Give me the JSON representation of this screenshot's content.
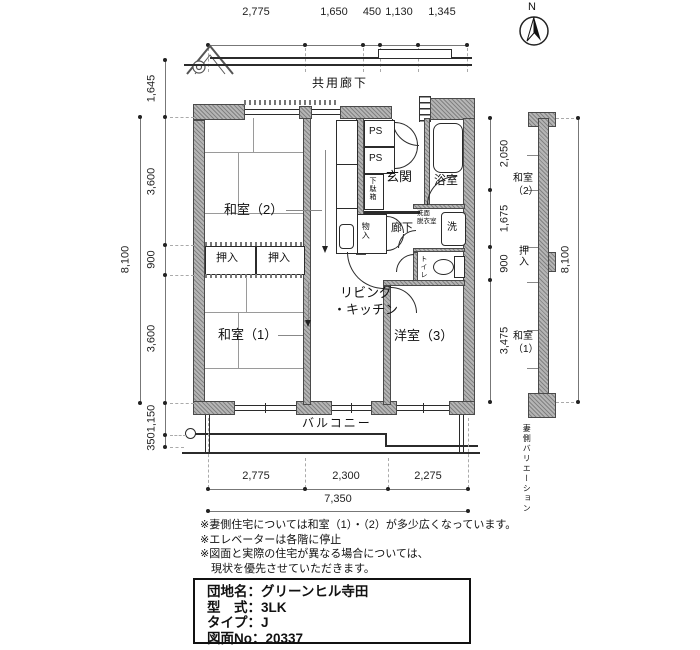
{
  "compass": {
    "n": "N"
  },
  "corridor": {
    "label": "共用廊下"
  },
  "dims": {
    "top": [
      "2,775",
      "1,650",
      "450",
      "1,130",
      "1,345"
    ],
    "left": [
      "1,645",
      "3,600",
      "900",
      "3,600",
      "1,150",
      "350"
    ],
    "left_overall": "8,100",
    "bottom": [
      "2,775",
      "2,300",
      "2,275"
    ],
    "bottom_overall": "7,350",
    "right": [
      "2,050",
      "1,675",
      "900",
      "3,475"
    ],
    "right_overall": "8,100"
  },
  "rooms": {
    "washitsu2": "和室（2）",
    "washitsu1": "和室（1）",
    "living_l1": "リビング",
    "living_l2": "・キッチン",
    "youshitsu3": "洋室（3）",
    "genkan": "玄関",
    "bath": "浴室",
    "ps1": "PS",
    "ps2": "PS",
    "getabako": "下駄箱",
    "oshiire1": "押入",
    "oshiire2": "押入",
    "monoire": "物入",
    "rouka": "廊下",
    "toire": "トイレ",
    "senmen_l1": "洗面",
    "senmen_l2": "脱衣室",
    "sen": "洗",
    "balcony": "バルコニー"
  },
  "variation": {
    "room2_l1": "和室",
    "room2_l2": "（2）",
    "oshiire": "押入",
    "room1_l1": "和室",
    "room1_l2": "（1）",
    "caption": "妻側バリエーション"
  },
  "notes": [
    "※妻側住宅については和室（1）・（2）が多少広くなっています。",
    "※エレベーターは各階に停止",
    "※図面と実際の住宅が異なる場合については、",
    "　現状を優先させていただきます。"
  ],
  "info": [
    "団地名：グリーンヒル寺田",
    "型　式：3LK",
    "タイプ：J",
    "図面No：20337"
  ]
}
